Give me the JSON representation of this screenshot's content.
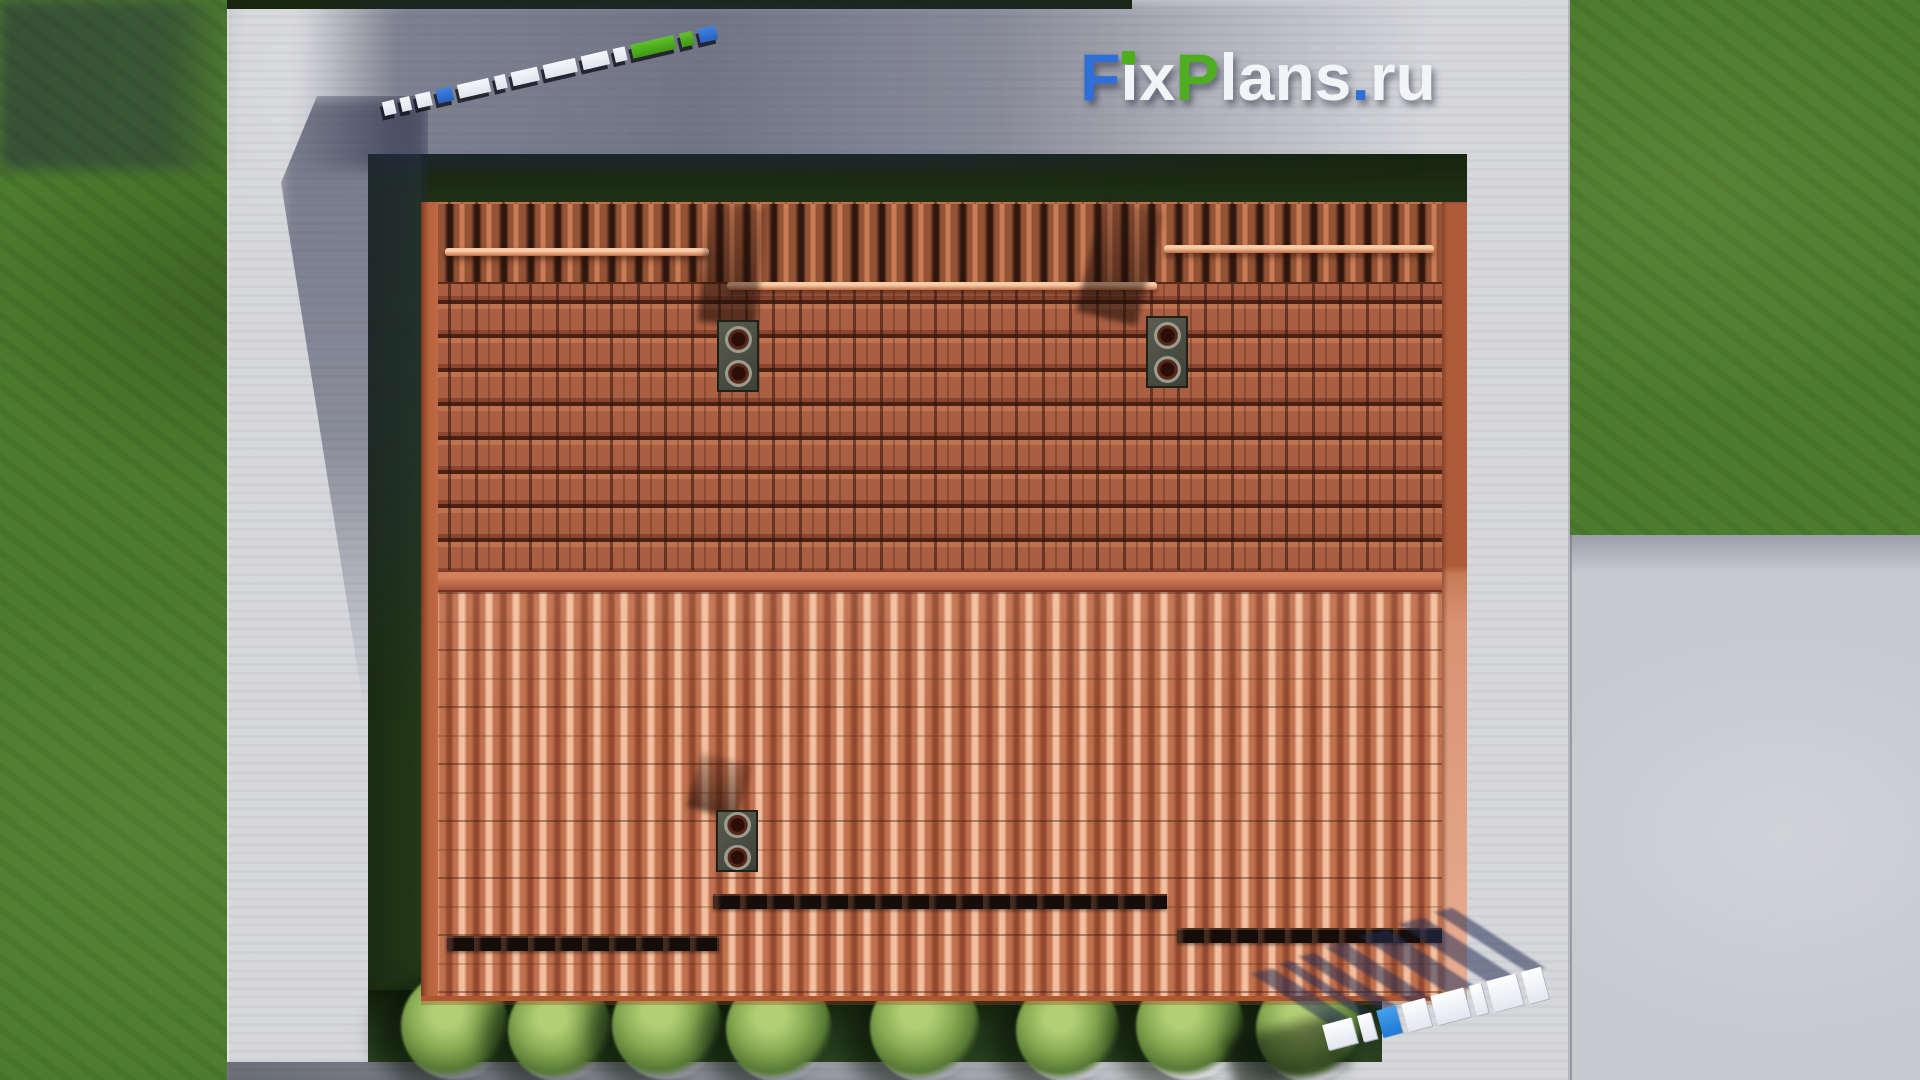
{
  "brand": {
    "name": "FixPlans.ru",
    "segments": {
      "f": "F",
      "i": "i",
      "x": "x",
      "p": "P",
      "lans": "lans",
      "dot": ".",
      "ru": "ru"
    },
    "colors": {
      "blue": "#2e6fd8",
      "green": "#4fae1f",
      "white": "#f3f4f7"
    }
  },
  "scene": {
    "colors": {
      "grass": "#4e7c2e",
      "grass_shadow": "#1f3114",
      "walkway_concrete": "#d6d7db",
      "driveway_concrete": "#c7c9cf",
      "cast_shadow_tint": "#222846",
      "roof_upper_tiles": "#ab5f42",
      "roof_lower_tiles": "#c0714e",
      "roof_ridge": "#bd6845",
      "roof_fascia": "#b5613c",
      "snow_guard_upper": "#e9b48c",
      "snow_guard_lower": "#150d09",
      "chimney": "#474a3e"
    }
  }
}
